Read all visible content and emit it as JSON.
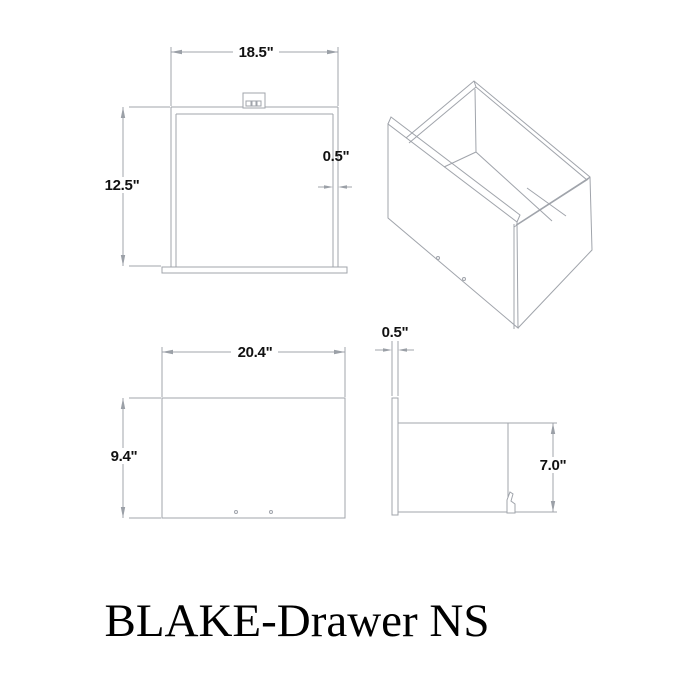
{
  "colors": {
    "background": "#ffffff",
    "drawing_line": "#a0a4ab",
    "dimension_text": "#111111",
    "title_text": "#000000"
  },
  "title": "BLAKE-Drawer NS",
  "views": {
    "top": {
      "width": "18.5\"",
      "height": "12.5\"",
      "wall_thickness": "0.5\""
    },
    "front": {
      "width": "20.4\"",
      "height": "9.4\""
    },
    "side": {
      "panel_thickness": "0.5\"",
      "box_height": "7.0\""
    }
  }
}
